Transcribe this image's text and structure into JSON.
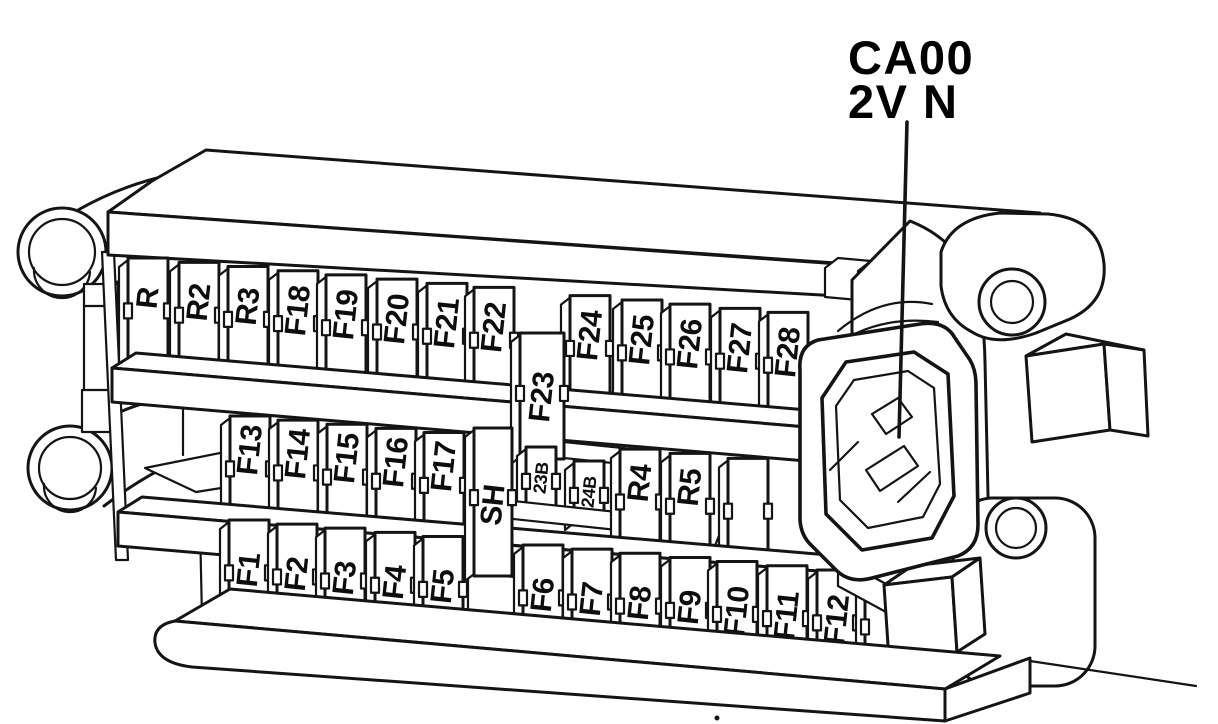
{
  "diagram": {
    "callout": {
      "line1": "CA00",
      "line2": "2V N"
    },
    "rows": {
      "top": [
        "R",
        "R2",
        "R3",
        "F18",
        "F19",
        "F20",
        "F21",
        "F22",
        "F24",
        "F25",
        "F26",
        "F27",
        "F28"
      ],
      "middle": [
        "F13",
        "F14",
        "F15",
        "F16",
        "F17",
        "R4",
        "R5"
      ],
      "bottom": [
        "F1",
        "F2",
        "F3",
        "F4",
        "F5",
        "F6",
        "F7",
        "F8",
        "F9",
        "F10",
        "F11",
        "F12"
      ],
      "tall_fuse": "F23",
      "shunt": "SH",
      "small_fuses": [
        "23B",
        "24B"
      ]
    },
    "colors": {
      "ink": "#141414",
      "paper": "#ffffff"
    }
  }
}
